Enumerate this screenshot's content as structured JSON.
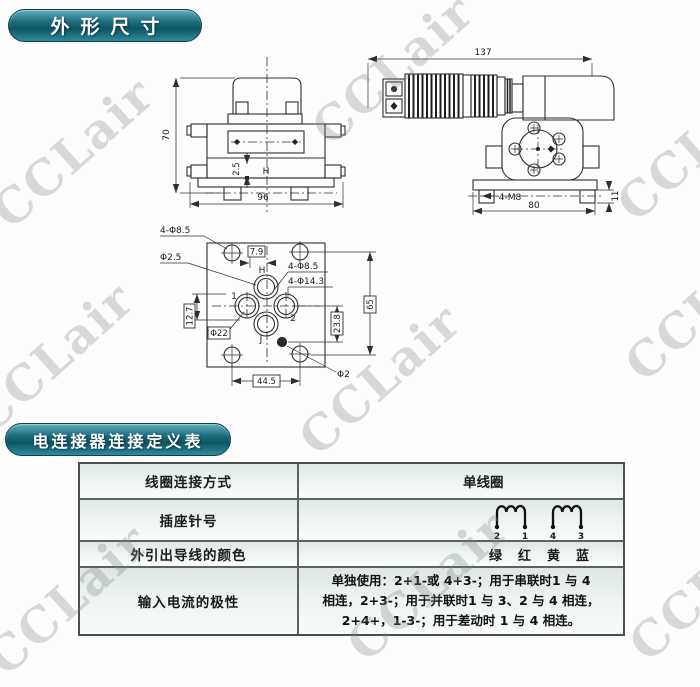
{
  "watermark": {
    "text": "CCLair"
  },
  "headers": {
    "dimensions": "外形尺寸",
    "connector_table": "电连接器连接定义表"
  },
  "front_view": {
    "height": "70",
    "width": "96",
    "offset": "2.5",
    "port": "H"
  },
  "side_view": {
    "length": "137",
    "width": "80",
    "thread": "4-M8",
    "foot": "11"
  },
  "bottom_view": {
    "corner_holes": "4-Φ8.5",
    "small_hole": "Φ2.5",
    "offset": "7.9",
    "port_h": "H",
    "holes_b": "4-Φ8.5",
    "holes_c": "4-Φ14.3",
    "port_1": "1",
    "port_2": "2",
    "port_j": "J",
    "spigot": "Φ22",
    "dim_left": "12.7",
    "dim_right": "23.8",
    "dim_height": "65",
    "dim_width": "44.5",
    "pin_hole": "Φ2"
  },
  "table": {
    "rows": [
      {
        "label": "线圈连接方式",
        "value": "单线圈"
      },
      {
        "label": "插座针号",
        "pins": [
          "2",
          "1",
          "4",
          "3"
        ]
      },
      {
        "label": "外引出导线的颜色",
        "colors": [
          "绿",
          "红",
          "黄",
          "蓝"
        ]
      },
      {
        "label": "输入电流的极性",
        "lines": [
          "单独使用：2+1-或 4+3-；用于串联时1 与 4",
          "相连，2+3-；用于并联时1 与 3、2 与 4 相连，",
          "2+4+，1-3-；用于差动时 1 与 4 相连。"
        ]
      }
    ]
  }
}
